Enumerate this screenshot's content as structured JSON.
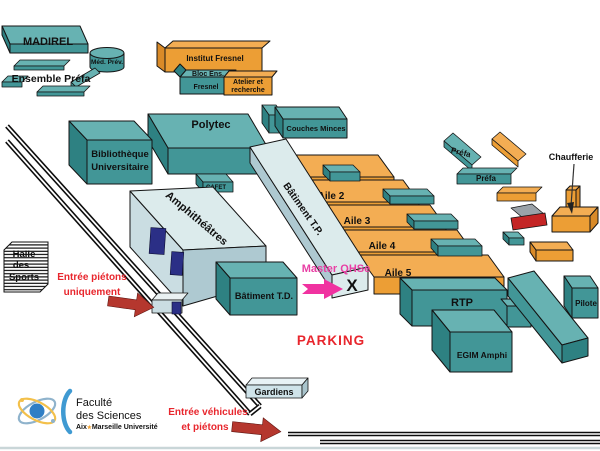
{
  "colors": {
    "teal_top": "#67b2b2",
    "teal_front": "#429697",
    "teal_side": "#2e8182",
    "orange_top": "#f3ad53",
    "orange_front": "#ec9e35",
    "orange_side": "#d98a28",
    "light_top": "#dcebec",
    "light_front": "#cadde2",
    "light_side": "#aec9d1",
    "navy": "#2b2f86",
    "red_text": "#e8262d",
    "arrow_red": "#b5372e",
    "magenta": "#e83fa4",
    "magenta_arrow": "#f032a0",
    "red_slab": "#c42525",
    "gray_slab": "#9aa2a8",
    "gardiens_fill": "#cfe3e9",
    "gate_fill": "#eaf1f2",
    "logo_blue": "#3f9ad2",
    "logo_text": "#3d3d46",
    "logo_star": "#f0a030",
    "logo_orbit_gray": "#8fb3cc",
    "logo_orbit_orange": "#f3c04a",
    "logo_nucleus": "#2f7fc5",
    "bottom_line": "#c9d6d8"
  },
  "buildings": {
    "madirel": "MADIREL",
    "med_prev": "Méd. Prév.",
    "ensemble_prefa": "Ensemble Préfa",
    "institut_fresnel": "Institut Fresnel",
    "bloc_ens": {
      "line1": "Bloc Ens.",
      "line2": "Fresnel"
    },
    "atelier": {
      "line1": "Atelier et",
      "line2": "recherche"
    },
    "polytec": "Polytec",
    "couches_minces": "Couches Minces",
    "bibliotheque": {
      "line1": "Bibliothèque",
      "line2": "Universitaire"
    },
    "cafet": "CAFET",
    "amphitheatres": "Amphithéâtres",
    "batiment_tp": "Bâtiment T.P.",
    "aile1": "Aile 1",
    "aile2": "Aile 2",
    "aile3": "Aile 3",
    "aile4": "Aile 4",
    "aile5": "Aile 5",
    "batiment_td": "Bâtiment T.D.",
    "rtp": "RTP",
    "egim_amphi": "EGIM Amphi",
    "pilote": "Pilote",
    "prefa_1": "Préfa",
    "prefa_2": "Préfa",
    "chaufferie": "Chaufferie",
    "gardiens": "Gardiens",
    "halle": {
      "line1": "Halle",
      "line2": "des",
      "line3": "Sports"
    }
  },
  "annotations": {
    "master": {
      "label": "Master QHSe",
      "x_mark": "X"
    },
    "parking": "PARKING",
    "entree_pietons": {
      "line1": "Entrée piétons",
      "line2": "uniquement"
    },
    "entree_vehicules": {
      "line1": "Entrée véhicules",
      "line2": "et piétons"
    }
  },
  "logo": {
    "line1": "Faculté",
    "line2": "des Sciences",
    "sub": {
      "prefix": "Aix",
      "star": "★",
      "suffix": "Marseille Université"
    }
  }
}
